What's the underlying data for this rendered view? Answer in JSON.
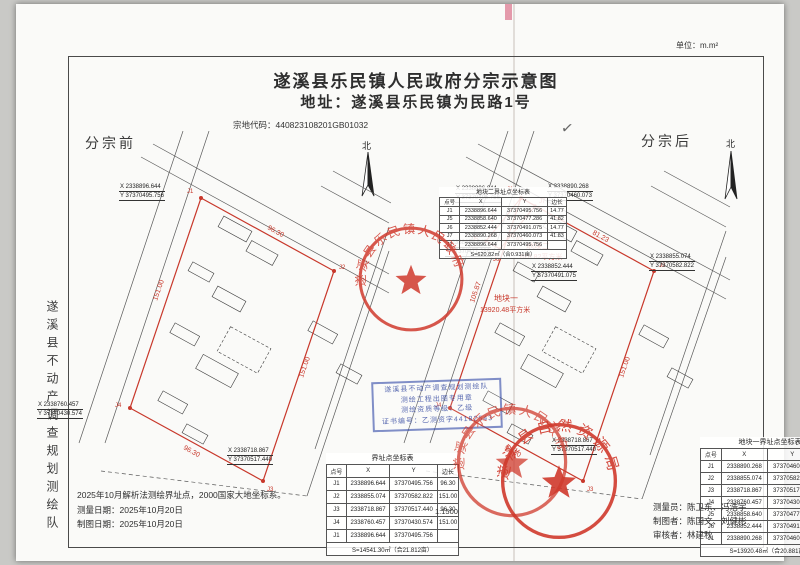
{
  "page": {
    "unit": "单位：m.m²",
    "scale": "1:1500",
    "check": "✓"
  },
  "header": {
    "title": "遂溪县乐民镇人民政府分宗示意图",
    "subtitle": "地址：遂溪县乐民镇为民路1号",
    "parcel_code": "宗地代码：440823108201GB01032"
  },
  "strip": {
    "text": "遂溪县不动产调查规划测绘队"
  },
  "colors": {
    "boundary_red": "#c8382b",
    "stamp_red": "#d03a2d",
    "stamp_blue": "#2d46a5"
  },
  "before": {
    "label": "分宗前",
    "north": "北",
    "ann": [
      {
        "x": "X 2338896.644",
        "y": "Y 37370495.756"
      },
      {
        "x": "X 2338760.457",
        "y": "Y 37370430.574"
      },
      {
        "x": "X 2338718.867",
        "y": "Y 37370517.440"
      }
    ],
    "edges": {
      "e1": "96.30",
      "e2": "151.00",
      "e3": "96.30",
      "e4": "151.00"
    },
    "pts": {
      "j1": "J1",
      "j2": "J2",
      "j3": "J3",
      "j4": "J4"
    }
  },
  "after": {
    "label": "分宗后",
    "north": "北",
    "ann": [
      {
        "x": "X 2338896.644",
        "y": "Y 37370495.756"
      },
      {
        "x": "X 2338890.268",
        "y": "Y 37370460.073"
      },
      {
        "x": "X 2338858.640",
        "y": "Y 37370477.286"
      },
      {
        "x": "X 2338852.444",
        "y": "Y 37370491.075"
      },
      {
        "x": "X 2338855.074",
        "y": "Y 37370582.822"
      },
      {
        "x": "X 2338718.867",
        "y": "Y 37370517.440"
      }
    ],
    "edges": {
      "e1": "81.23",
      "e2": "151.00",
      "e3": "96.30",
      "e4": "105.87",
      "e5": "14.77",
      "e6": "41.82"
    },
    "pts": {
      "j1": "J1",
      "j2": "J2",
      "j3": "J3",
      "j4": "J4",
      "j5": "J5",
      "j6": "J6",
      "j7": "J7"
    },
    "parcel1": {
      "name": "地块一",
      "area": "13920.48平方米"
    },
    "parcel2": {
      "name": "地块二",
      "area": "620.82平方米"
    }
  },
  "tables": {
    "before": {
      "title": "界址点坐标表",
      "headers": [
        "点号",
        "X",
        "Y",
        "边长"
      ],
      "rows": [
        {
          "p": "J1",
          "x": "2338896.644",
          "y": "37370495.756",
          "e": "96.30"
        },
        {
          "p": "J2",
          "x": "2338855.074",
          "y": "37370582.822",
          "e": "151.00"
        },
        {
          "p": "J3",
          "x": "2338718.867",
          "y": "37370517.440",
          "e": "96.30"
        },
        {
          "p": "J4",
          "x": "2338760.457",
          "y": "37370430.574",
          "e": "151.00"
        },
        {
          "p": "J1",
          "x": "2338896.644",
          "y": "37370495.756",
          "e": ""
        }
      ],
      "sum": "S=14541.30㎡（合21.812亩）"
    },
    "parcel1": {
      "title": "地块一界址点坐标表",
      "headers": [
        "点号",
        "X",
        "Y",
        "边长"
      ],
      "rows": [
        {
          "p": "J1",
          "x": "2338890.268",
          "y": "37370460.073",
          "e": "81.23"
        },
        {
          "p": "J2",
          "x": "2338855.074",
          "y": "37370582.822",
          "e": "151.00"
        },
        {
          "p": "J3",
          "x": "2338718.867",
          "y": "37370517.440",
          "e": "96.30"
        },
        {
          "p": "J4",
          "x": "2338760.457",
          "y": "37370430.574",
          "e": "105.87"
        },
        {
          "p": "J5",
          "x": "2338858.640",
          "y": "37370477.286",
          "e": "14.77"
        },
        {
          "p": "J6",
          "x": "2338852.444",
          "y": "37370491.075",
          "e": "41.83"
        },
        {
          "p": "J1",
          "x": "2338890.268",
          "y": "37370460.073",
          "e": ""
        }
      ],
      "sum": "S=13920.48㎡（合20.881亩）"
    },
    "parcel2": {
      "title": "地块二界址点坐标表",
      "headers": [
        "点号",
        "X",
        "Y",
        "边长"
      ],
      "rows": [
        {
          "p": "J1",
          "x": "2338896.644",
          "y": "37370495.756",
          "e": "14.77"
        },
        {
          "p": "J5",
          "x": "2338858.640",
          "y": "37370477.286",
          "e": "41.82"
        },
        {
          "p": "J6",
          "x": "2338852.444",
          "y": "37370491.075",
          "e": "14.77"
        },
        {
          "p": "J7",
          "x": "2338890.268",
          "y": "37370460.073",
          "e": "41.83"
        },
        {
          "p": "J1",
          "x": "2338896.644",
          "y": "37370495.756",
          "e": ""
        }
      ],
      "sum": "S=620.82㎡（合0.931亩）"
    }
  },
  "stamps": {
    "gov": "遂溪县乐民镇人民政府",
    "nat": "遂溪县自然资源局",
    "blue": [
      "遂溪县不动产调查规划测绘队",
      "测绘工程出图专用章",
      "测绘资质等级：乙级",
      "证书编号：乙测资字44182543"
    ]
  },
  "footer": {
    "note": "2025年10月解析法测绘界址点，2000国家大地坐标系。",
    "d1": "测量日期：2025年10月20日",
    "d2": "制图日期：2025年10月20日",
    "p1": "测量员：陈卫东、冯浩宇",
    "p2": "制图者：陈国文、刘健彬",
    "p3": "审核者：林建秋"
  }
}
